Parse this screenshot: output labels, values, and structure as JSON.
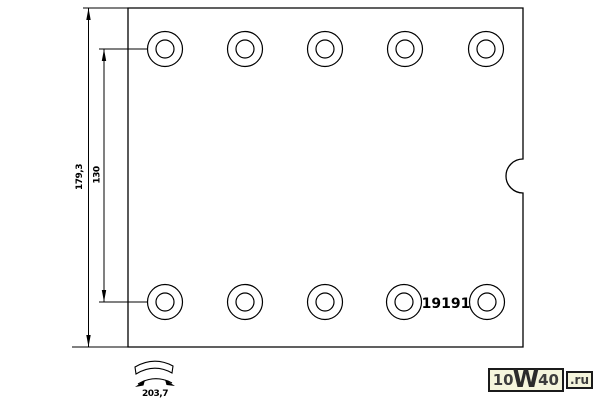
{
  "drawing": {
    "part_number": "19191",
    "dimensions": {
      "height": "179,3",
      "hole_span": "130",
      "arc_width": "203,7"
    }
  },
  "watermark": {
    "prefix": "10",
    "w": "W",
    "suffix": "40",
    "tld": ".ru"
  },
  "colors": {
    "background": "#ffffff",
    "line": "#000000",
    "watermark_bg": "#f5f5dc",
    "watermark_border": "#1b1b1b",
    "watermark_text": "#3d3d3d"
  }
}
